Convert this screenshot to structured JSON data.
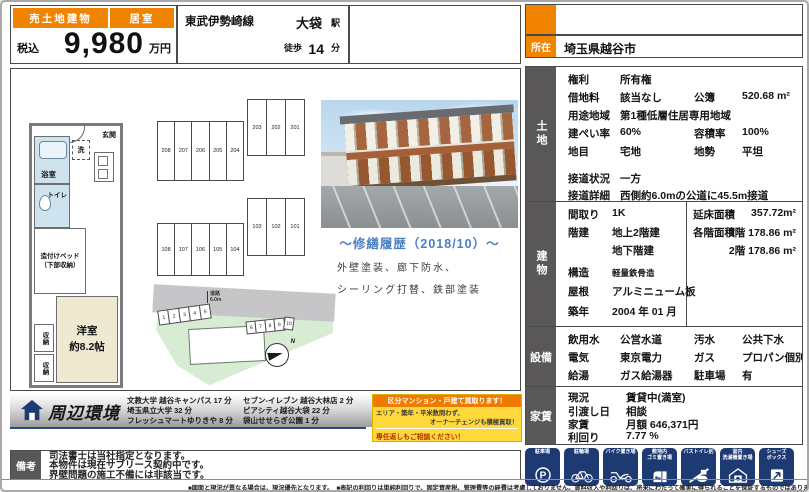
{
  "title_bar": {
    "sale_type": "売土地建物",
    "room_type": "居室",
    "tax_label": "税込",
    "price": "9,980",
    "price_unit": "万円",
    "rail_line": "東武伊勢崎線",
    "station": "大袋",
    "station_suffix": "駅",
    "walk_label": "徒歩",
    "walk_minutes": "14",
    "walk_unit": "分",
    "location_label": "所在",
    "location": "埼玉県越谷市"
  },
  "floorplan": {
    "entrance": "玄関",
    "washer": "洗",
    "bath": "浴室",
    "toilet": "トイレ",
    "bed_line1": "造付けベッド",
    "bed_line2": "（下部収納）",
    "main_room": "洋室",
    "main_room_size": "約8.2帖",
    "closet_a": "収納",
    "closet_b": "収納"
  },
  "site": {
    "road_label": "道路",
    "road_width": "6.0m",
    "compass": "N",
    "f2_left": [
      "208",
      "207",
      "206",
      "205",
      "204"
    ],
    "f2_right": [
      "203",
      "202",
      "201"
    ],
    "f1_left": [
      "108",
      "107",
      "106",
      "105",
      "104"
    ],
    "f1_right": [
      "103",
      "102",
      "101"
    ],
    "parking_left": [
      "1",
      "2",
      "3",
      "4",
      "5"
    ],
    "parking_right": [
      "6",
      "7",
      "8",
      "9",
      "10"
    ]
  },
  "renovation": {
    "title": "～修繕履歴（2018/10）～",
    "line1": "外壁塗装、廊下防水、",
    "line2": "シーリング打替、鉄部塗装"
  },
  "land": {
    "label": "土地",
    "rows": [
      [
        "権利",
        "所有権",
        "",
        ""
      ],
      [
        "借地料",
        "該当なし",
        "公簿",
        "520.68 m²"
      ],
      [
        "用途地域",
        "第1種低層住居専用地域",
        "",
        ""
      ],
      [
        "建ぺい率",
        "60%",
        "容積率",
        "100%"
      ],
      [
        "地目",
        "宅地",
        "地勢",
        "平坦"
      ],
      [
        "接道状況",
        "一方",
        "",
        ""
      ],
      [
        "接道詳細",
        "西側約6.0mの公道に45.5m接道",
        "",
        ""
      ]
    ]
  },
  "building": {
    "label": "建物",
    "left_rows": [
      [
        "間取り",
        "1K"
      ],
      [
        "階建",
        "地上2階建"
      ],
      [
        "",
        "地下階建"
      ],
      [
        "構造",
        "軽量鉄骨造"
      ],
      [
        "屋根",
        "アルミニューム板"
      ],
      [
        "築年",
        "2004 年 01 月"
      ]
    ],
    "right_rows": [
      [
        "延床面積",
        "357.72m²"
      ],
      [
        "各階面積",
        "1階 178.86 m²"
      ],
      [
        "",
        "2階 178.86 m²"
      ]
    ]
  },
  "facilities": {
    "label": "設備",
    "rows": [
      [
        "飲用水",
        "公営水道",
        "汚水",
        "公共下水"
      ],
      [
        "電気",
        "東京電力",
        "ガス",
        "プロパン個別方"
      ],
      [
        "給湯",
        "ガス給湯器",
        "駐車場",
        "有"
      ]
    ]
  },
  "rent": {
    "label": "家賃",
    "rows": [
      [
        "現況",
        "賃貸中(満室)"
      ],
      [
        "引渡し日",
        "相談"
      ],
      [
        "家賃",
        "月額 646,371円"
      ],
      [
        "利回り",
        "7.77 %"
      ]
    ]
  },
  "amenities": [
    {
      "icon": "parking-icon",
      "caption": "駐車場"
    },
    {
      "icon": "bicycle-parking-icon",
      "caption": "駐輪場"
    },
    {
      "icon": "motorbike-parking-icon",
      "caption": "バイク置き場"
    },
    {
      "icon": "garbage-area-icon",
      "caption": "敷地内\nゴミ置き場"
    },
    {
      "icon": "separate-bath-toilet-icon",
      "caption": "バストイレ別"
    },
    {
      "icon": "indoor-laundry-icon",
      "caption": "室内\n洗濯機置き場"
    },
    {
      "icon": "shoe-box-icon",
      "caption": "シューズ\nボックス"
    }
  ],
  "environment": {
    "title": "周辺環境",
    "col1": [
      "文教大学 越谷キャンパス 17 分",
      "埼玉県立大学 32 分",
      "フレッシュマートゆりきや 8 分"
    ],
    "col2": [
      "セブン-イレブン 越谷大林店 2 分",
      "ピアシティ越谷大袋 22 分",
      "袋山せせらぎ公園 1 分"
    ]
  },
  "ad_box": {
    "header": "区分マンション・戸建て買取ります！",
    "line1": "エリア・築年・平米数問わず、",
    "line2": "オーナーチェンジも積極買取！",
    "line3": "専任返しもご相談ください！"
  },
  "remarks": {
    "label": "備考",
    "lines": [
      "司法書士は当社指定となります。",
      "本物件は現在サブリース契約中です。",
      "界壁問題の施工不備には非該当です。"
    ]
  },
  "footer_note": "■図面と現況が異なる場合は、現況優先となります。　■表記の利回りは単純利回りで、固定資産税、管理費等の経費は考慮しておりません。賃料収入や利回りは、将来にわたって確実に得られることを保証するものではありません。",
  "colors": {
    "accent_orange": "#f08300",
    "label_gray": "#595757",
    "badge_navy": "#1e3a72",
    "ad_yellow": "#ffd83c",
    "reno_blue": "#4c7fc4"
  }
}
